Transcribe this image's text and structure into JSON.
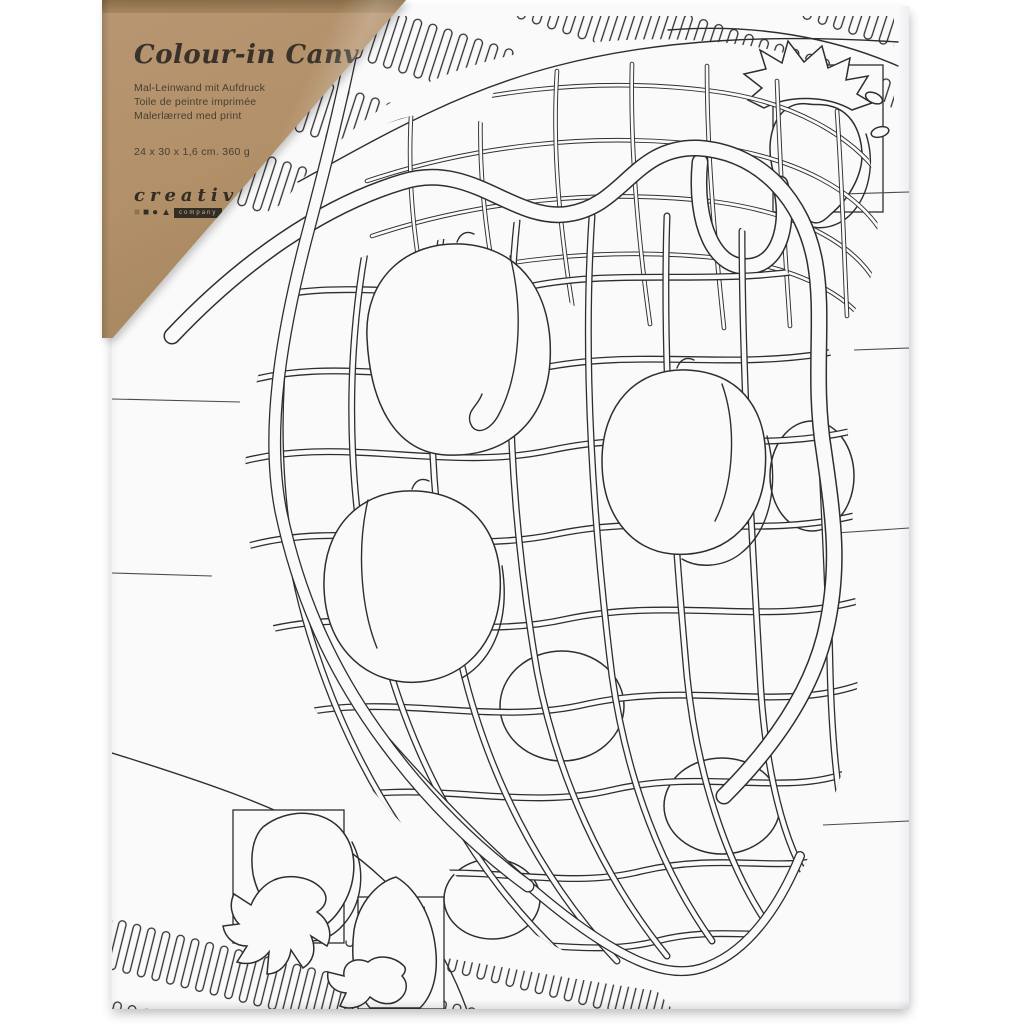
{
  "scene": {
    "description": "Product photo of a colour-in canvas: white stretched canvas printed with black outline colouring art (a string net bag filled with peaches, strawberries in square frames, dashed wavy borders) and a kraft paper corner label under clear wrap",
    "background_color": "#ffffff",
    "canvas_color": "#fafafb",
    "art_line_color": "#2e2e2e"
  },
  "label": {
    "title": "Colour-in Canvas",
    "subtitles": [
      "Mal-Leinwand mit Aufdruck",
      "Toile de peintre imprimée",
      "Malerlærred med print"
    ],
    "dimensions": "24 x 30 x 1,6 cm. 360 g",
    "brand": {
      "name": "creativ",
      "suffix": "company",
      "shapes": [
        "■",
        "■",
        "●",
        "▲"
      ],
      "kraft_color": "#b2906a",
      "text_color": "#3a332a"
    }
  },
  "artwork": {
    "motifs": [
      "net shopping bag",
      "peaches",
      "strawberries in square frames",
      "dashed wavy borders",
      "horizontal background lines"
    ]
  }
}
